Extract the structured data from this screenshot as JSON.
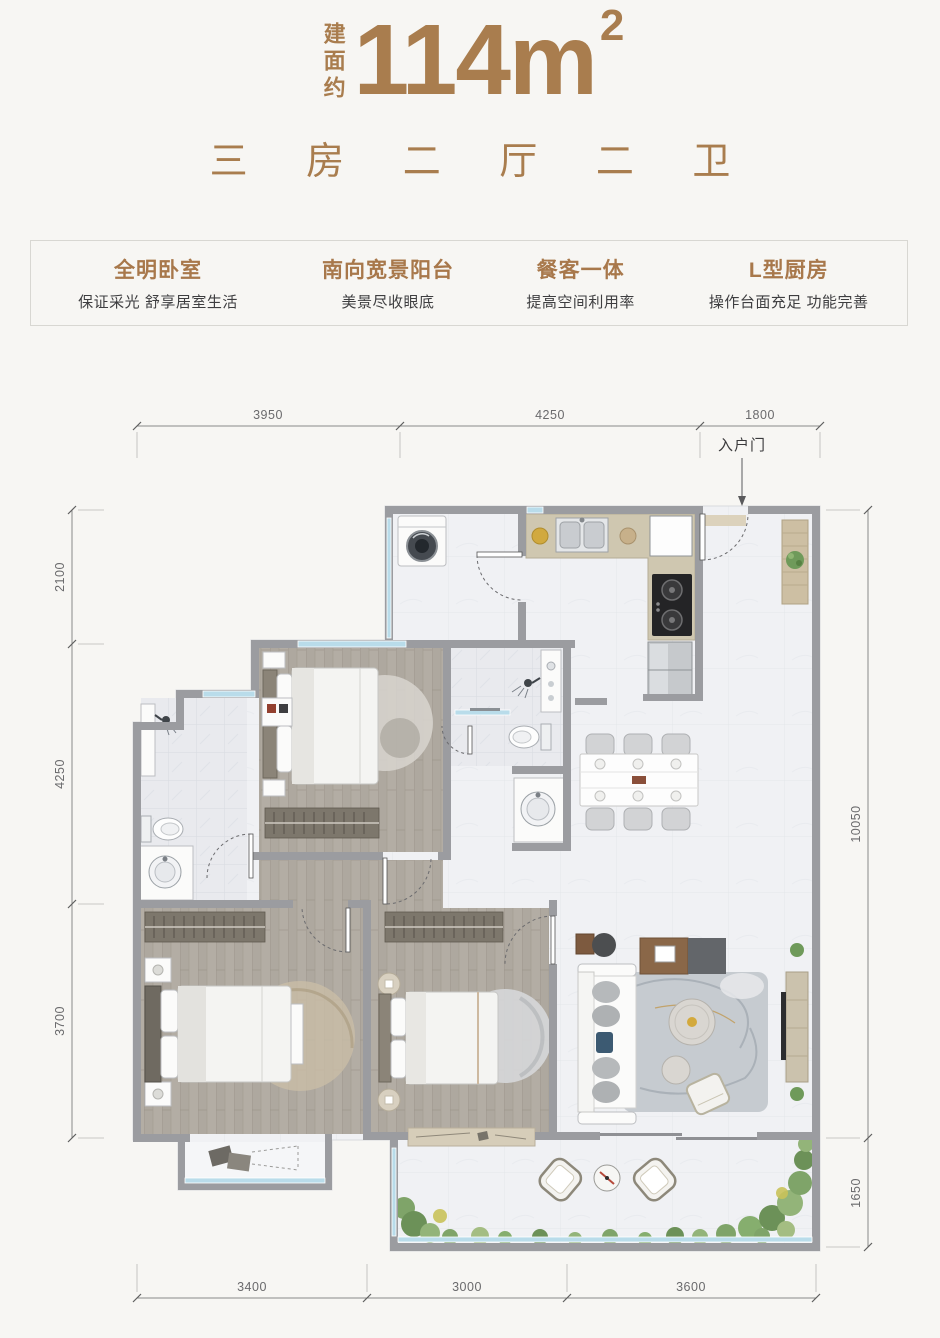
{
  "header": {
    "area_prefix": "建面约",
    "area_value": "114m",
    "area_exponent": "2",
    "layout_line": "三 房 二 厅 二 卫"
  },
  "features": [
    {
      "title": "全明卧室",
      "desc": "保证采光 舒享居室生活"
    },
    {
      "title": "南向宽景阳台",
      "desc": "美景尽收眼底"
    },
    {
      "title": "餐客一体",
      "desc": "提高空间利用率"
    },
    {
      "title": "L型厨房",
      "desc": "操作台面充足 功能完善"
    }
  ],
  "plan": {
    "entrance_label": "入户门",
    "dimensions": {
      "top": [
        "3950",
        "4250",
        "1800"
      ],
      "left": [
        "2100",
        "4250",
        "3700"
      ],
      "right": [
        "10050",
        "1650"
      ],
      "bottom": [
        "3400",
        "3000",
        "3600"
      ]
    }
  },
  "colors": {
    "accent": "#a97d4e",
    "subtext": "#3e3e40",
    "wall": "#9b9ca0",
    "glass": "#b9dcea",
    "wood_floor": "#b2aca3"
  }
}
